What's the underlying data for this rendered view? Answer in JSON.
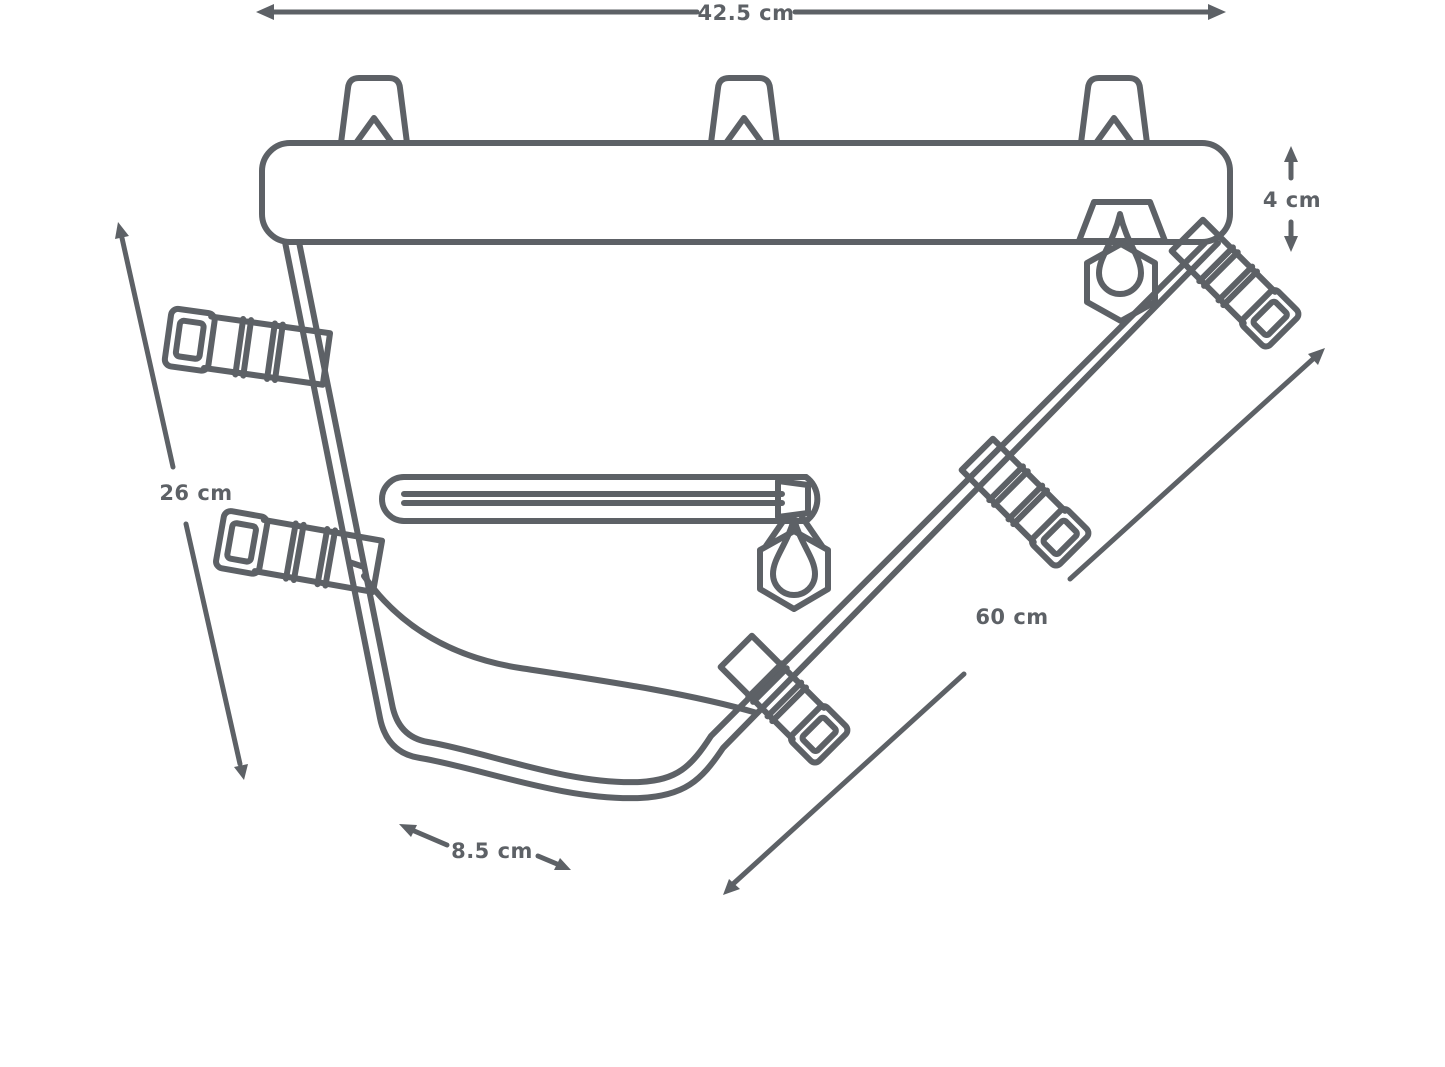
{
  "diagram": {
    "line_color": "#5d6166",
    "background_color": "#ffffff",
    "dimensions": {
      "top_width": "42.5 cm",
      "sleeve_height": "4 cm",
      "front_height": "26 cm",
      "downtube_length": "60 cm",
      "bottom_depth": "8.5 cm"
    }
  }
}
